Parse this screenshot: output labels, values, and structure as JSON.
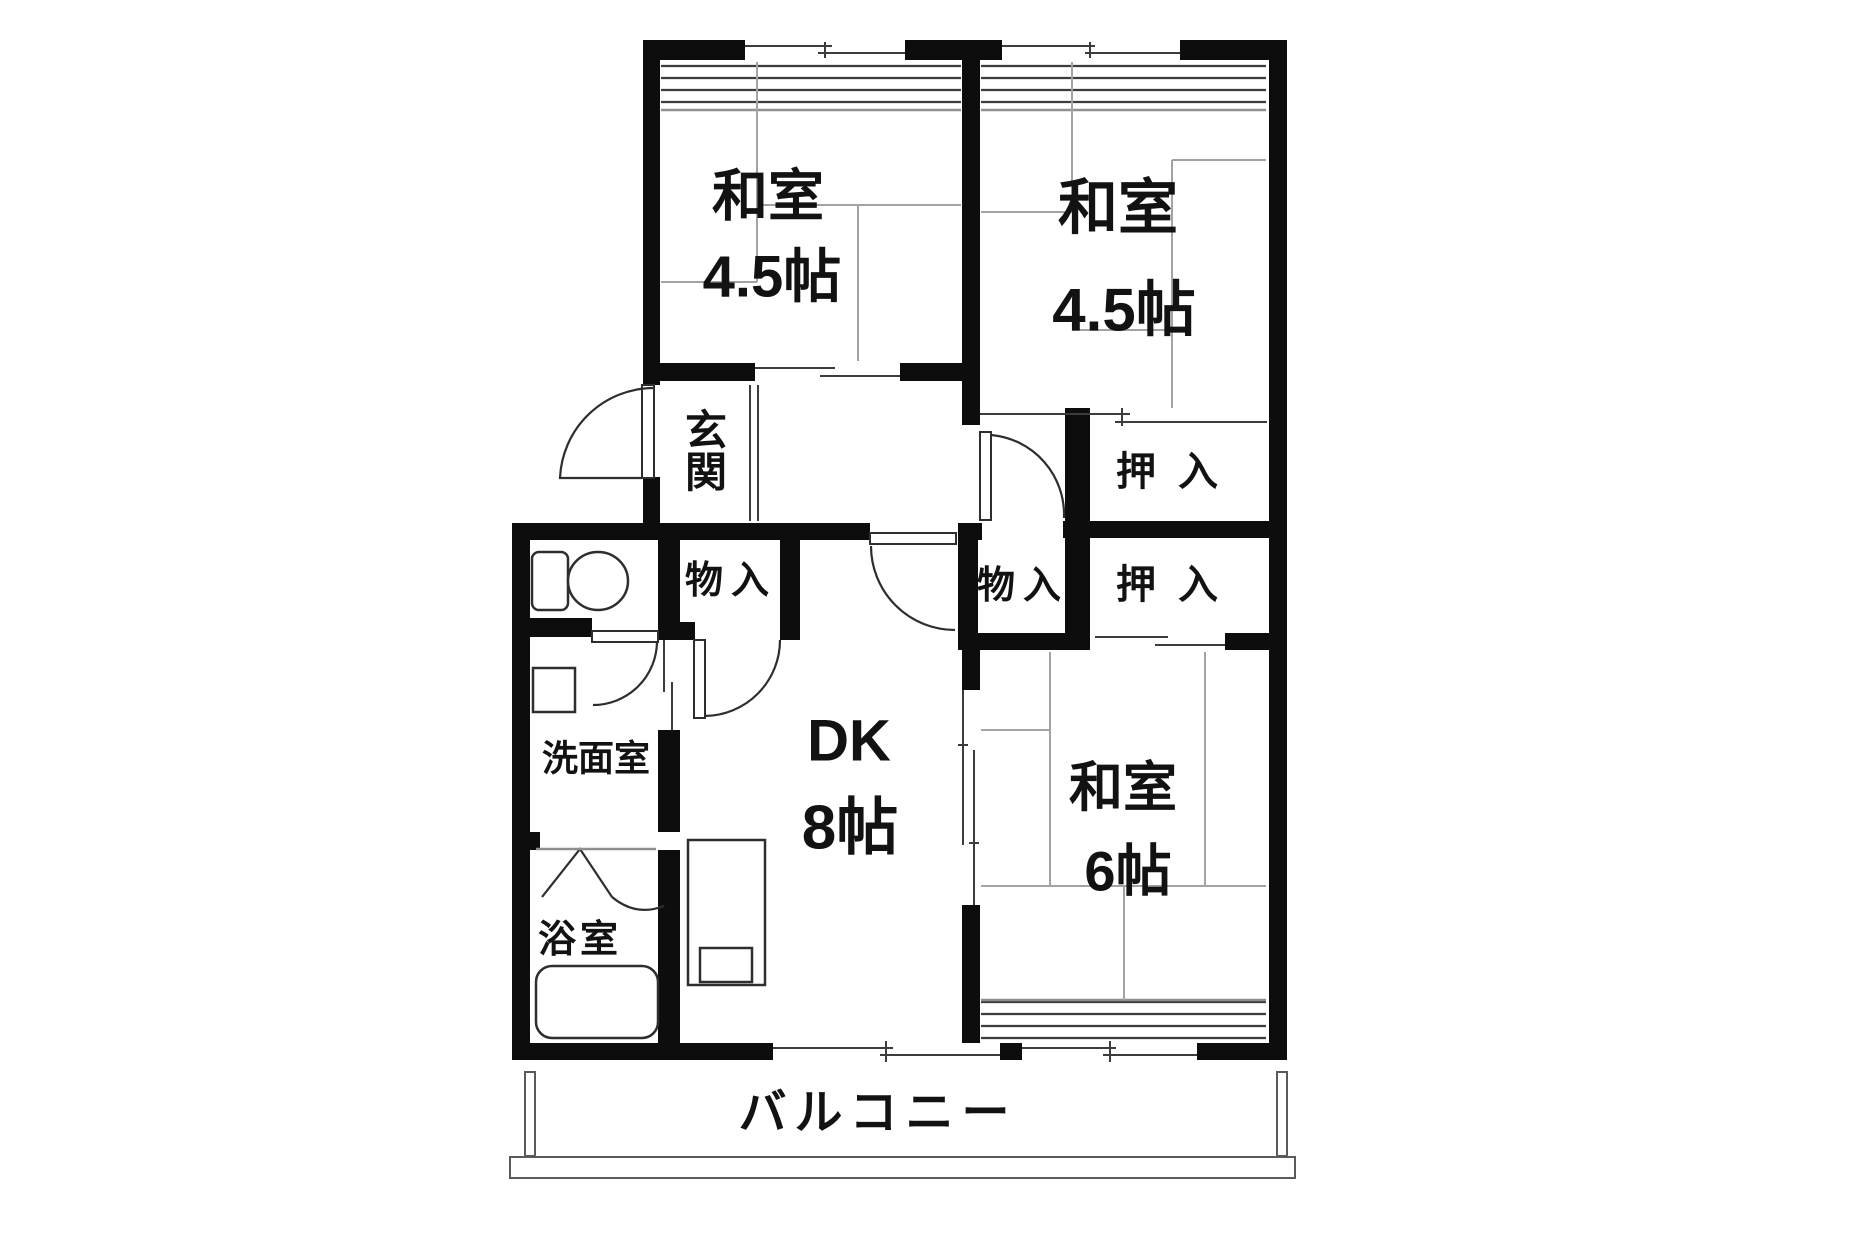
{
  "floor_plan": {
    "type": "japanese-apartment-madori",
    "rooms": {
      "japanese_room_top_left": {
        "label": "和室",
        "size": "4.5帖"
      },
      "japanese_room_top_right": {
        "label": "和室",
        "size": "4.5帖"
      },
      "japanese_room_right": {
        "label": "和室",
        "size": "6帖"
      },
      "dining_kitchen": {
        "label": "DK",
        "size": "8帖"
      },
      "entrance": {
        "label": "玄関"
      },
      "closet_1": {
        "label": "押入"
      },
      "closet_2": {
        "label": "押入"
      },
      "storage_1": {
        "label": "物入"
      },
      "storage_2": {
        "label": "物入"
      },
      "washroom": {
        "label": "洗面室"
      },
      "bathroom": {
        "label": "浴室"
      },
      "balcony": {
        "label": "バルコニー"
      }
    },
    "fixtures": [
      "toilet",
      "wash-basin",
      "bathtub",
      "kitchen-counter-with-sink"
    ],
    "colors": {
      "background": "#ffffff",
      "wall": "#0d0d0d",
      "line": "#3c3c3c",
      "tatami_line": "#a3a3a3",
      "text": "#121212"
    }
  }
}
